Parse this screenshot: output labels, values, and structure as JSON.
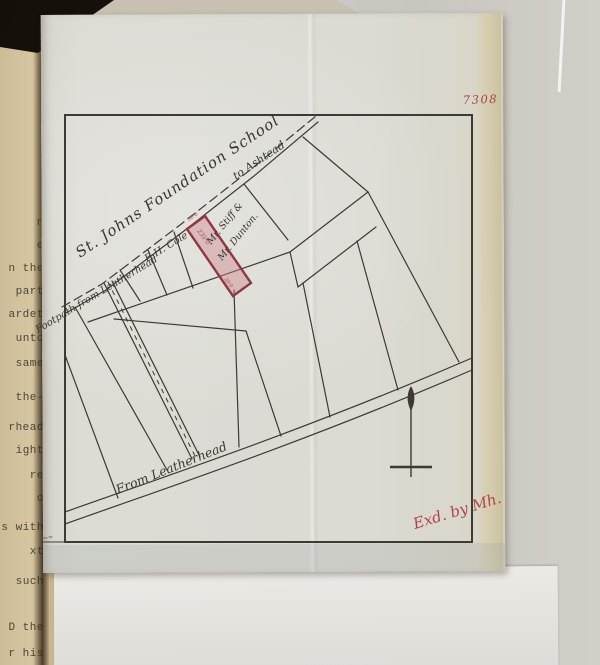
{
  "archive": {
    "document_number": "7308",
    "examined_signature": "Exd. by Mh."
  },
  "map": {
    "school_label": "St. Johns Foundation School",
    "footpath_label": "Footpath from Leatherhead",
    "to_ashtead_label": "to Ashtead",
    "road_label": "From Leatherhead",
    "owner_plot_left": "E.H. Cole",
    "owner_plot_right_line1": "Mr. Stiff &",
    "owner_plot_right_line2": "Mr. Dunton.",
    "highlighted_plot": {
      "dimension_top": "30·0",
      "dimension_side": "235·0",
      "dimension_bottom": "30·0"
    },
    "colors": {
      "ink": "#3d3a33",
      "red_ink": "#a8454e",
      "plot_fill": "#dfb9bd",
      "tracing_paper": "#dbdad3",
      "typed_page": "#d5c5a1"
    }
  },
  "typed_page": {
    "fragments": [
      {
        "text": "n"
      },
      {
        "text": "e"
      },
      {
        "text": "n the"
      },
      {
        "text": "part"
      },
      {
        "text": "ardet"
      },
      {
        "text": "unto"
      },
      {
        "text": "same"
      },
      {
        "text": "the-"
      },
      {
        "text": "rhead"
      },
      {
        "text": "ight"
      },
      {
        "text": "re"
      },
      {
        "text": "o"
      },
      {
        "text": "s with"
      },
      {
        "text": "xt"
      },
      {
        "text": "such"
      },
      {
        "text": "D the"
      },
      {
        "text": "r his"
      }
    ]
  }
}
